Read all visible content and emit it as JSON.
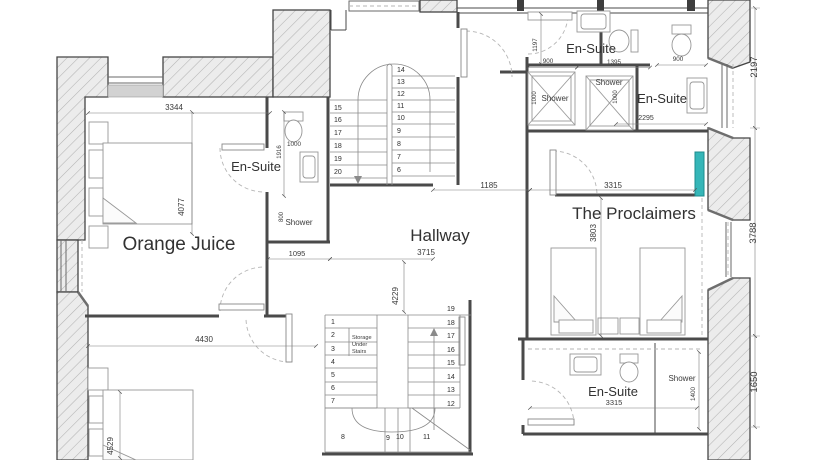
{
  "rooms": {
    "orange_juice": "Orange Juice",
    "hallway": "Hallway",
    "proclaimers": "The Proclaimers",
    "ensuite_left": "En-Suite",
    "ensuite_top": "En-Suite",
    "ensuite_top_right": "En-Suite",
    "ensuite_bottom": "En-Suite"
  },
  "labels": {
    "shower_left": "Shower",
    "shower_top_1": "Shower",
    "shower_top_2": "Shower",
    "shower_bottom": "Shower",
    "storage": [
      "Storage",
      "Under",
      "Stairs"
    ]
  },
  "dimensions": {
    "oj_top": "3344",
    "oj_bed": "4077",
    "bed2_width": "4430",
    "bed2_length": "4529",
    "ens_left_toilet": "1000",
    "ens_left_depth": "1916",
    "ens_left_shower": "800",
    "ens_left_width": "1095",
    "hall_width": "3715",
    "hall_length": "4229",
    "landing_opening": "1185",
    "proclaimers_width": "3315",
    "proclaimers_depth": "3803",
    "ens_top_depth": "1197",
    "ens_top_a": "900",
    "ens_top_b": "1395",
    "shower1": "1000",
    "shower2": "1000",
    "ens_right_toilet": "900",
    "ens_right_width": "2295",
    "right_top": "2197",
    "right_mid": "3788",
    "right_low": "1650",
    "ens_bottom_width": "3315",
    "ens_bottom_shower": "1400"
  },
  "stairs": {
    "upper_right": [
      "14",
      "13",
      "12",
      "11",
      "10",
      "9",
      "8",
      "7",
      "6"
    ],
    "upper_left": [
      "15",
      "16",
      "17",
      "18",
      "19",
      "20"
    ],
    "lower_left": [
      "1",
      "2",
      "3",
      "4",
      "5",
      "6",
      "7"
    ],
    "lower_winders": [
      "8",
      "9",
      "10",
      "11"
    ],
    "lower_right": [
      "19",
      "18",
      "17",
      "16",
      "15",
      "14",
      "13",
      "12"
    ]
  },
  "colors": {
    "window_accent": "#35b6b8",
    "wall_line": "#454545",
    "hatch": "#b3b3b3"
  }
}
